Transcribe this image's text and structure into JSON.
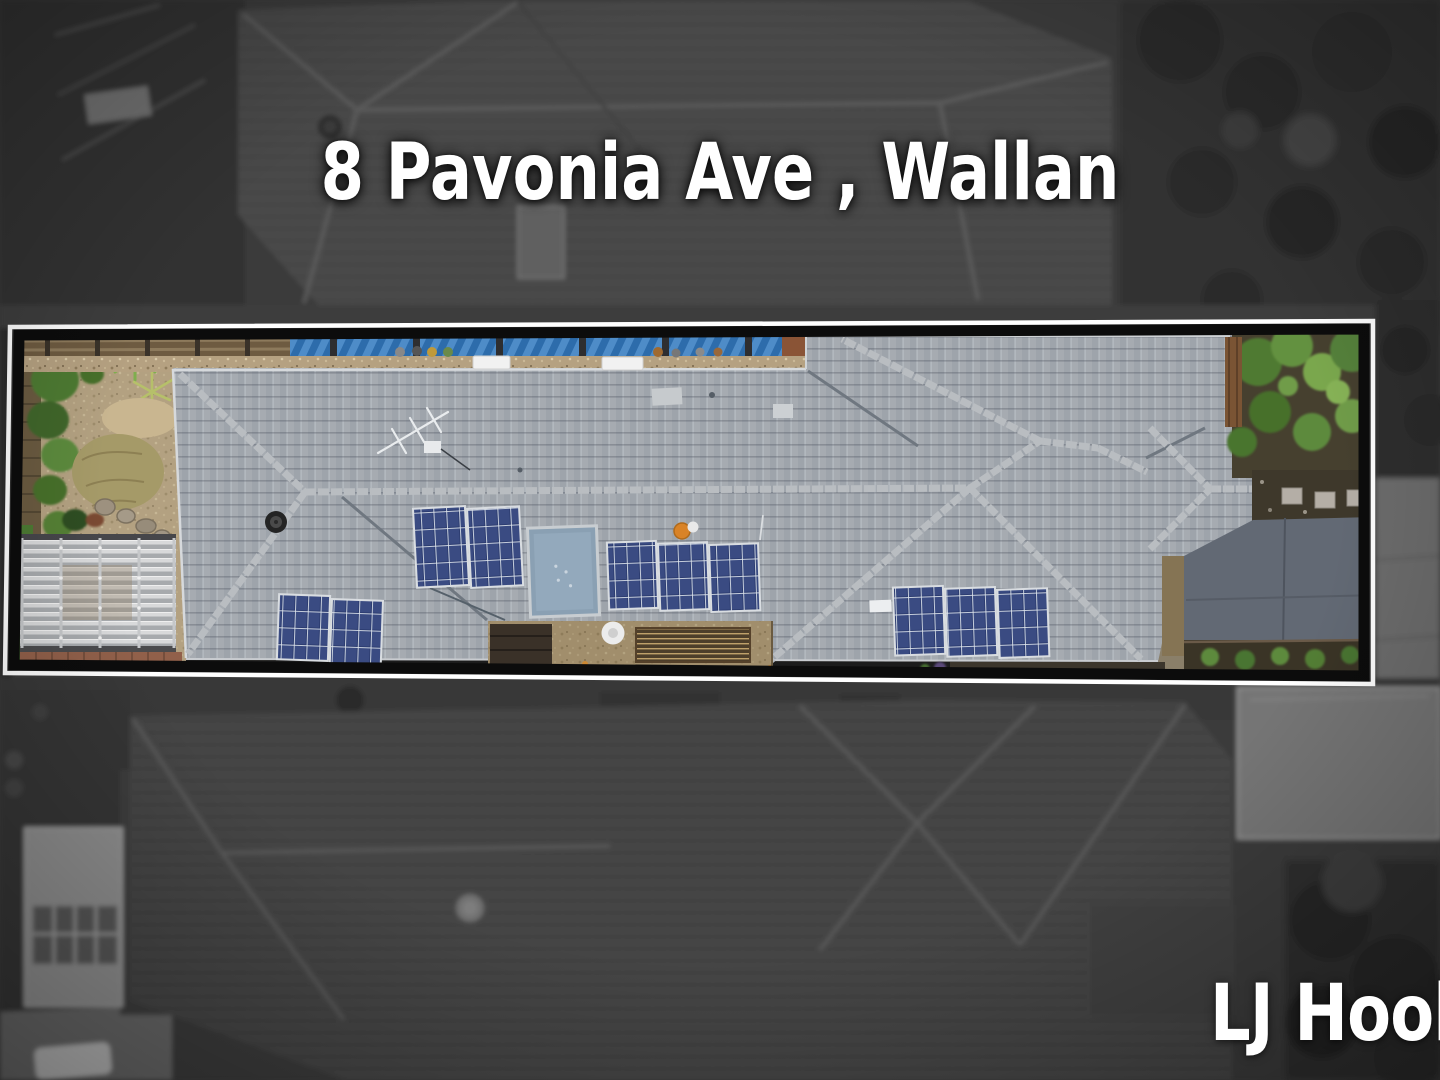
{
  "page": {
    "width": 1440,
    "height": 1080,
    "kind": "real-estate drone aerial photograph with highlighted property boundary"
  },
  "overlay": {
    "title": "8 Pavonia Ave , Wallan",
    "title_color": "#ffffff",
    "watermark": "LJ Hooker",
    "watermark_visible_portion": "LJ Hook",
    "watermark_color": "#ffffff"
  },
  "highlight": {
    "outline_outer_color": "#ffffff",
    "outline_inner_color": "#0c0c0c",
    "corners": [
      [
        10,
        327
      ],
      [
        1373,
        321
      ],
      [
        1373,
        684
      ],
      [
        5,
        673
      ]
    ],
    "contents": [
      "left garden beds with shrubs and dry lawn",
      "corrugated pergola roof",
      "long grey tiled hip roof",
      "tv antenna",
      "black roof vent",
      "four solar panel arrays (ten panels)",
      "large rectangular skylight",
      "gravel courtyard with timber slat deck and white round table",
      "blue corrugated fence along rear boundary",
      "green trees at right",
      "paver garden bed",
      "blue-grey concrete driveway"
    ]
  },
  "background": {
    "style": "desaturated greyscale neighbouring rooftops, slightly blurred with vignette",
    "base_color": "#3b3b3b"
  },
  "palette": {
    "roof_tile": "#a6abb1",
    "ridge_cap": "#b9bdc1",
    "solar_panel": "#2e3f72",
    "skylight": "#8aa0b3",
    "blue_fence": "#2d6cab",
    "driveway": "#626974",
    "tree_green": "#55813a",
    "gravel": "#b5a181"
  }
}
